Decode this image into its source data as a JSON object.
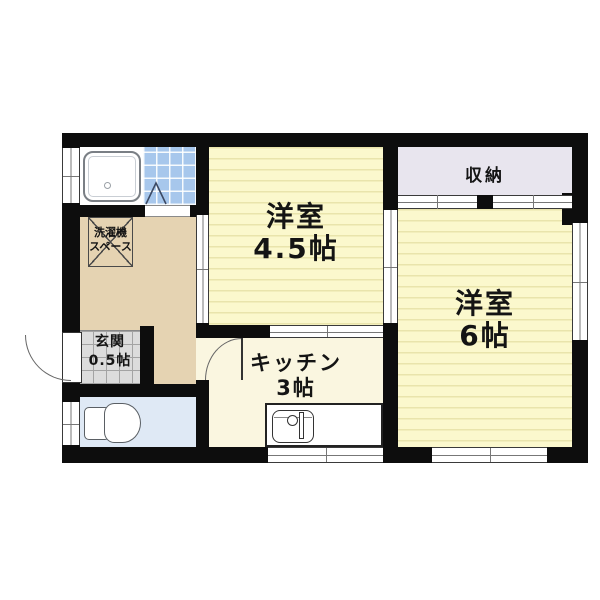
{
  "plan_type": "apartment-floor-plan",
  "rooms": {
    "western_room_a": {
      "name": "洋室",
      "size": "4.5帖"
    },
    "western_room_b": {
      "name": "洋室",
      "size": "6帖"
    },
    "kitchen": {
      "name": "キッチン",
      "size": "3帖"
    },
    "entrance": {
      "name": "玄関",
      "size": "0.5帖"
    },
    "storage": {
      "name": "収納"
    },
    "laundry_space": {
      "line1": "洗濯機",
      "line2": "スペース"
    }
  },
  "fixtures": [
    "bathtub",
    "toilet",
    "kitchen-sink",
    "washing-machine-space"
  ],
  "colors": {
    "wall": "#0d0d0d",
    "tatami_room": "#fbf8cd",
    "tatami_stripe": "#e9e4ac",
    "kitchen_floor": "#faf6e0",
    "hallway_floor": "#e5d3b2",
    "entrance_tile": "#dcdcdc",
    "toilet_floor": "#dfe9f5",
    "bath_tile": "#a7c7ec",
    "storage_floor": "#e8e5ee",
    "background": "#ffffff"
  }
}
